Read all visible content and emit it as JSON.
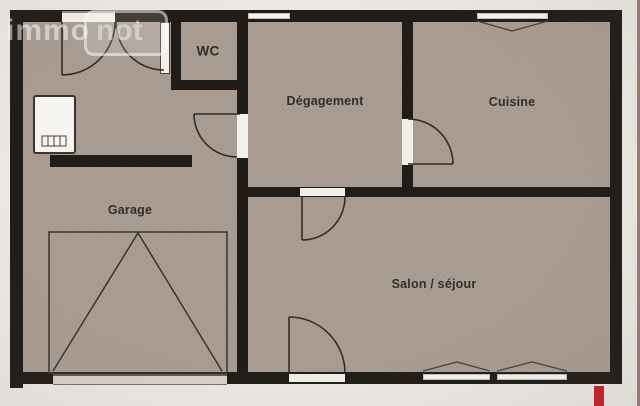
{
  "watermark": {
    "immo": "immo",
    "not": "not"
  },
  "rooms": {
    "wc": {
      "label": "WC"
    },
    "degagement": {
      "label": "Dégagement"
    },
    "cuisine": {
      "label": "Cuisine"
    },
    "garage": {
      "label": "Garage"
    },
    "salon": {
      "label": "Salon / séjour"
    }
  },
  "colors": {
    "wall": "#211c18",
    "floor": "#a89c92",
    "paper": "#ebe8e3",
    "accent_red": "#c22128",
    "watermark_white": "rgba(252,252,252,0.55)"
  }
}
